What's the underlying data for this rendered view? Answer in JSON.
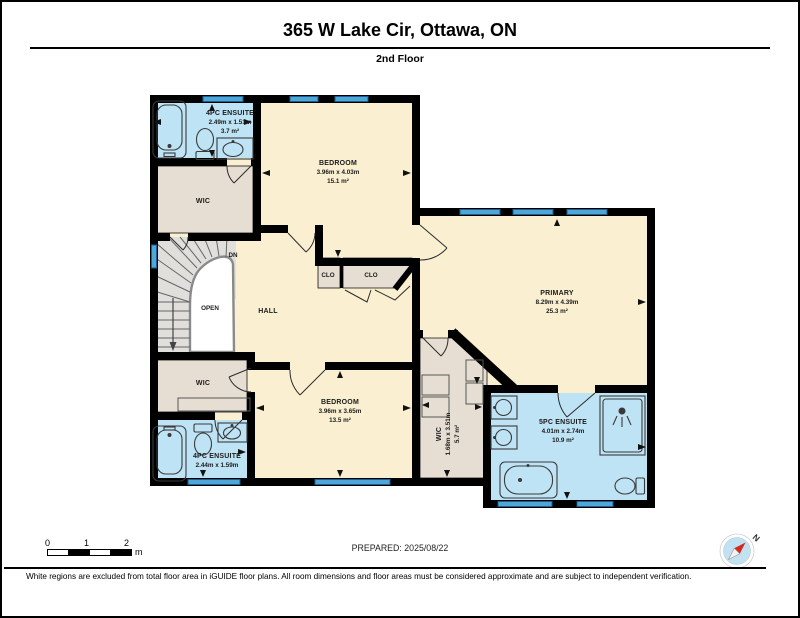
{
  "header": {
    "title": "365 W Lake Cir, Ottawa, ON",
    "subtitle": "2nd Floor"
  },
  "rooms": {
    "ensuite_top": {
      "name": "4PC ENSUITE",
      "dims": "2.49m x 1.51m",
      "area": "3.7 m²"
    },
    "bedroom_top": {
      "name": "BEDROOM",
      "dims": "3.96m x 4.03m",
      "area": "15.1 m²"
    },
    "wic_top": {
      "name": "WIC"
    },
    "stairs": {
      "down": "DN",
      "open": "OPEN"
    },
    "hall": {
      "name": "HALL"
    },
    "clo_left": {
      "name": "CLO"
    },
    "clo_right": {
      "name": "CLO"
    },
    "primary": {
      "name": "PRIMARY",
      "dims": "8.29m x 4.39m",
      "area": "25.3 m²"
    },
    "wic_mid": {
      "name": "WIC"
    },
    "bedroom_bottom": {
      "name": "BEDROOM",
      "dims": "3.96m x 3.65m",
      "area": "13.5 m²"
    },
    "wic_vertical": {
      "name": "WIC",
      "dims": "1.68m x 3.51m",
      "area": "5.7 m²"
    },
    "ensuite_5pc": {
      "name": "5PC ENSUITE",
      "dims": "4.01m x 2.74m",
      "area": "10.9 m²"
    },
    "ensuite_bottom": {
      "name": "4PC ENSUITE",
      "dims": "2.44m x 1.59m"
    }
  },
  "scale_bar": {
    "tick0": "0",
    "tick1": "1",
    "tick2": "2",
    "unit": "m"
  },
  "compass": {
    "label": "N"
  },
  "footer": {
    "prepared": "PREPARED: 2025/08/22",
    "disclaimer": "White regions are excluded from total floor area in iGUIDE floor plans. All room dimensions and floor areas must be considered approximate and are subject to independent verification."
  },
  "colors": {
    "floor": "#FAF0D1",
    "bath": "#BEE3F5",
    "closet": "#E6DED2",
    "stairs": "#E0DFDC",
    "window": "#4FA6D8",
    "wall": "#000000"
  }
}
